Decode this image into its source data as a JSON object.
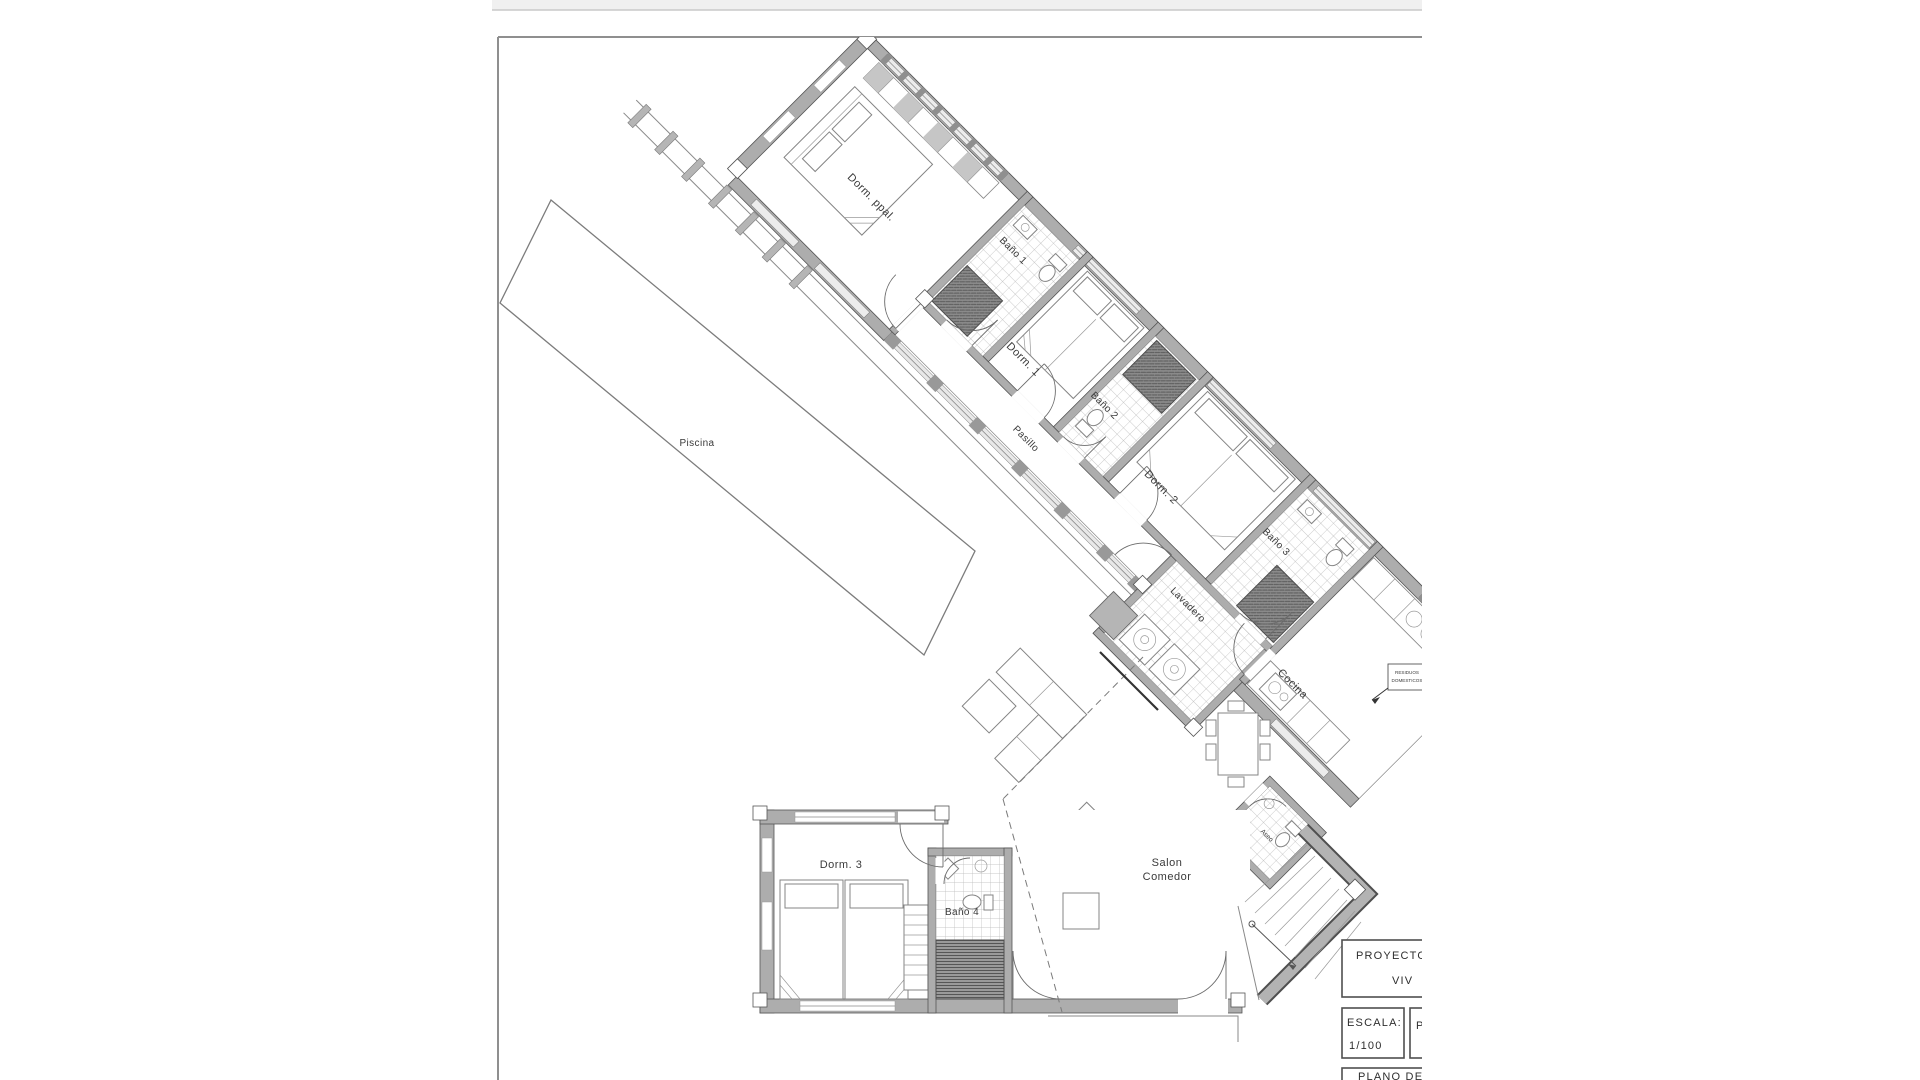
{
  "page": {
    "description": "Architectural floor plan drawing, cropped page",
    "scale_note": "1/100"
  },
  "plan": {
    "rooms": {
      "piscina": "Piscina",
      "dorm_ppal": "Dorm. ppal.",
      "bano1": "Baño 1",
      "dorm1": "Dorm. 1",
      "bano2": "Baño 2",
      "pasillo": "Pasillo",
      "dorm2": "Dorm. 2",
      "bano3": "Baño 3",
      "lavadero": "Lavadero",
      "cocina": "Cocina",
      "aseo": "Aseo",
      "salon_line1": "Salon",
      "salon_line2": "Comedor",
      "dorm3": "Dorm. 3",
      "bano4": "Baño 4"
    },
    "annotations": {
      "residuos_line1": "RESIDUOS",
      "residuos_line2": "DOMESTICOS"
    }
  },
  "title_block": {
    "proyecto_label": "PROYECTO  B",
    "proyecto_line2": "VIV",
    "escala_label": "ESCALA:",
    "escala_value": "1/100",
    "promotor_label": "PR",
    "plano_label": "PLANO  DE"
  },
  "colors": {
    "wall_gray": "#adadad",
    "wall_edge": "#555555",
    "shower_dark": "#7a7a7a",
    "tile_line": "#b9b9b9",
    "label_ink": "#3a3a3a",
    "top_band": "#f0f0f0"
  }
}
